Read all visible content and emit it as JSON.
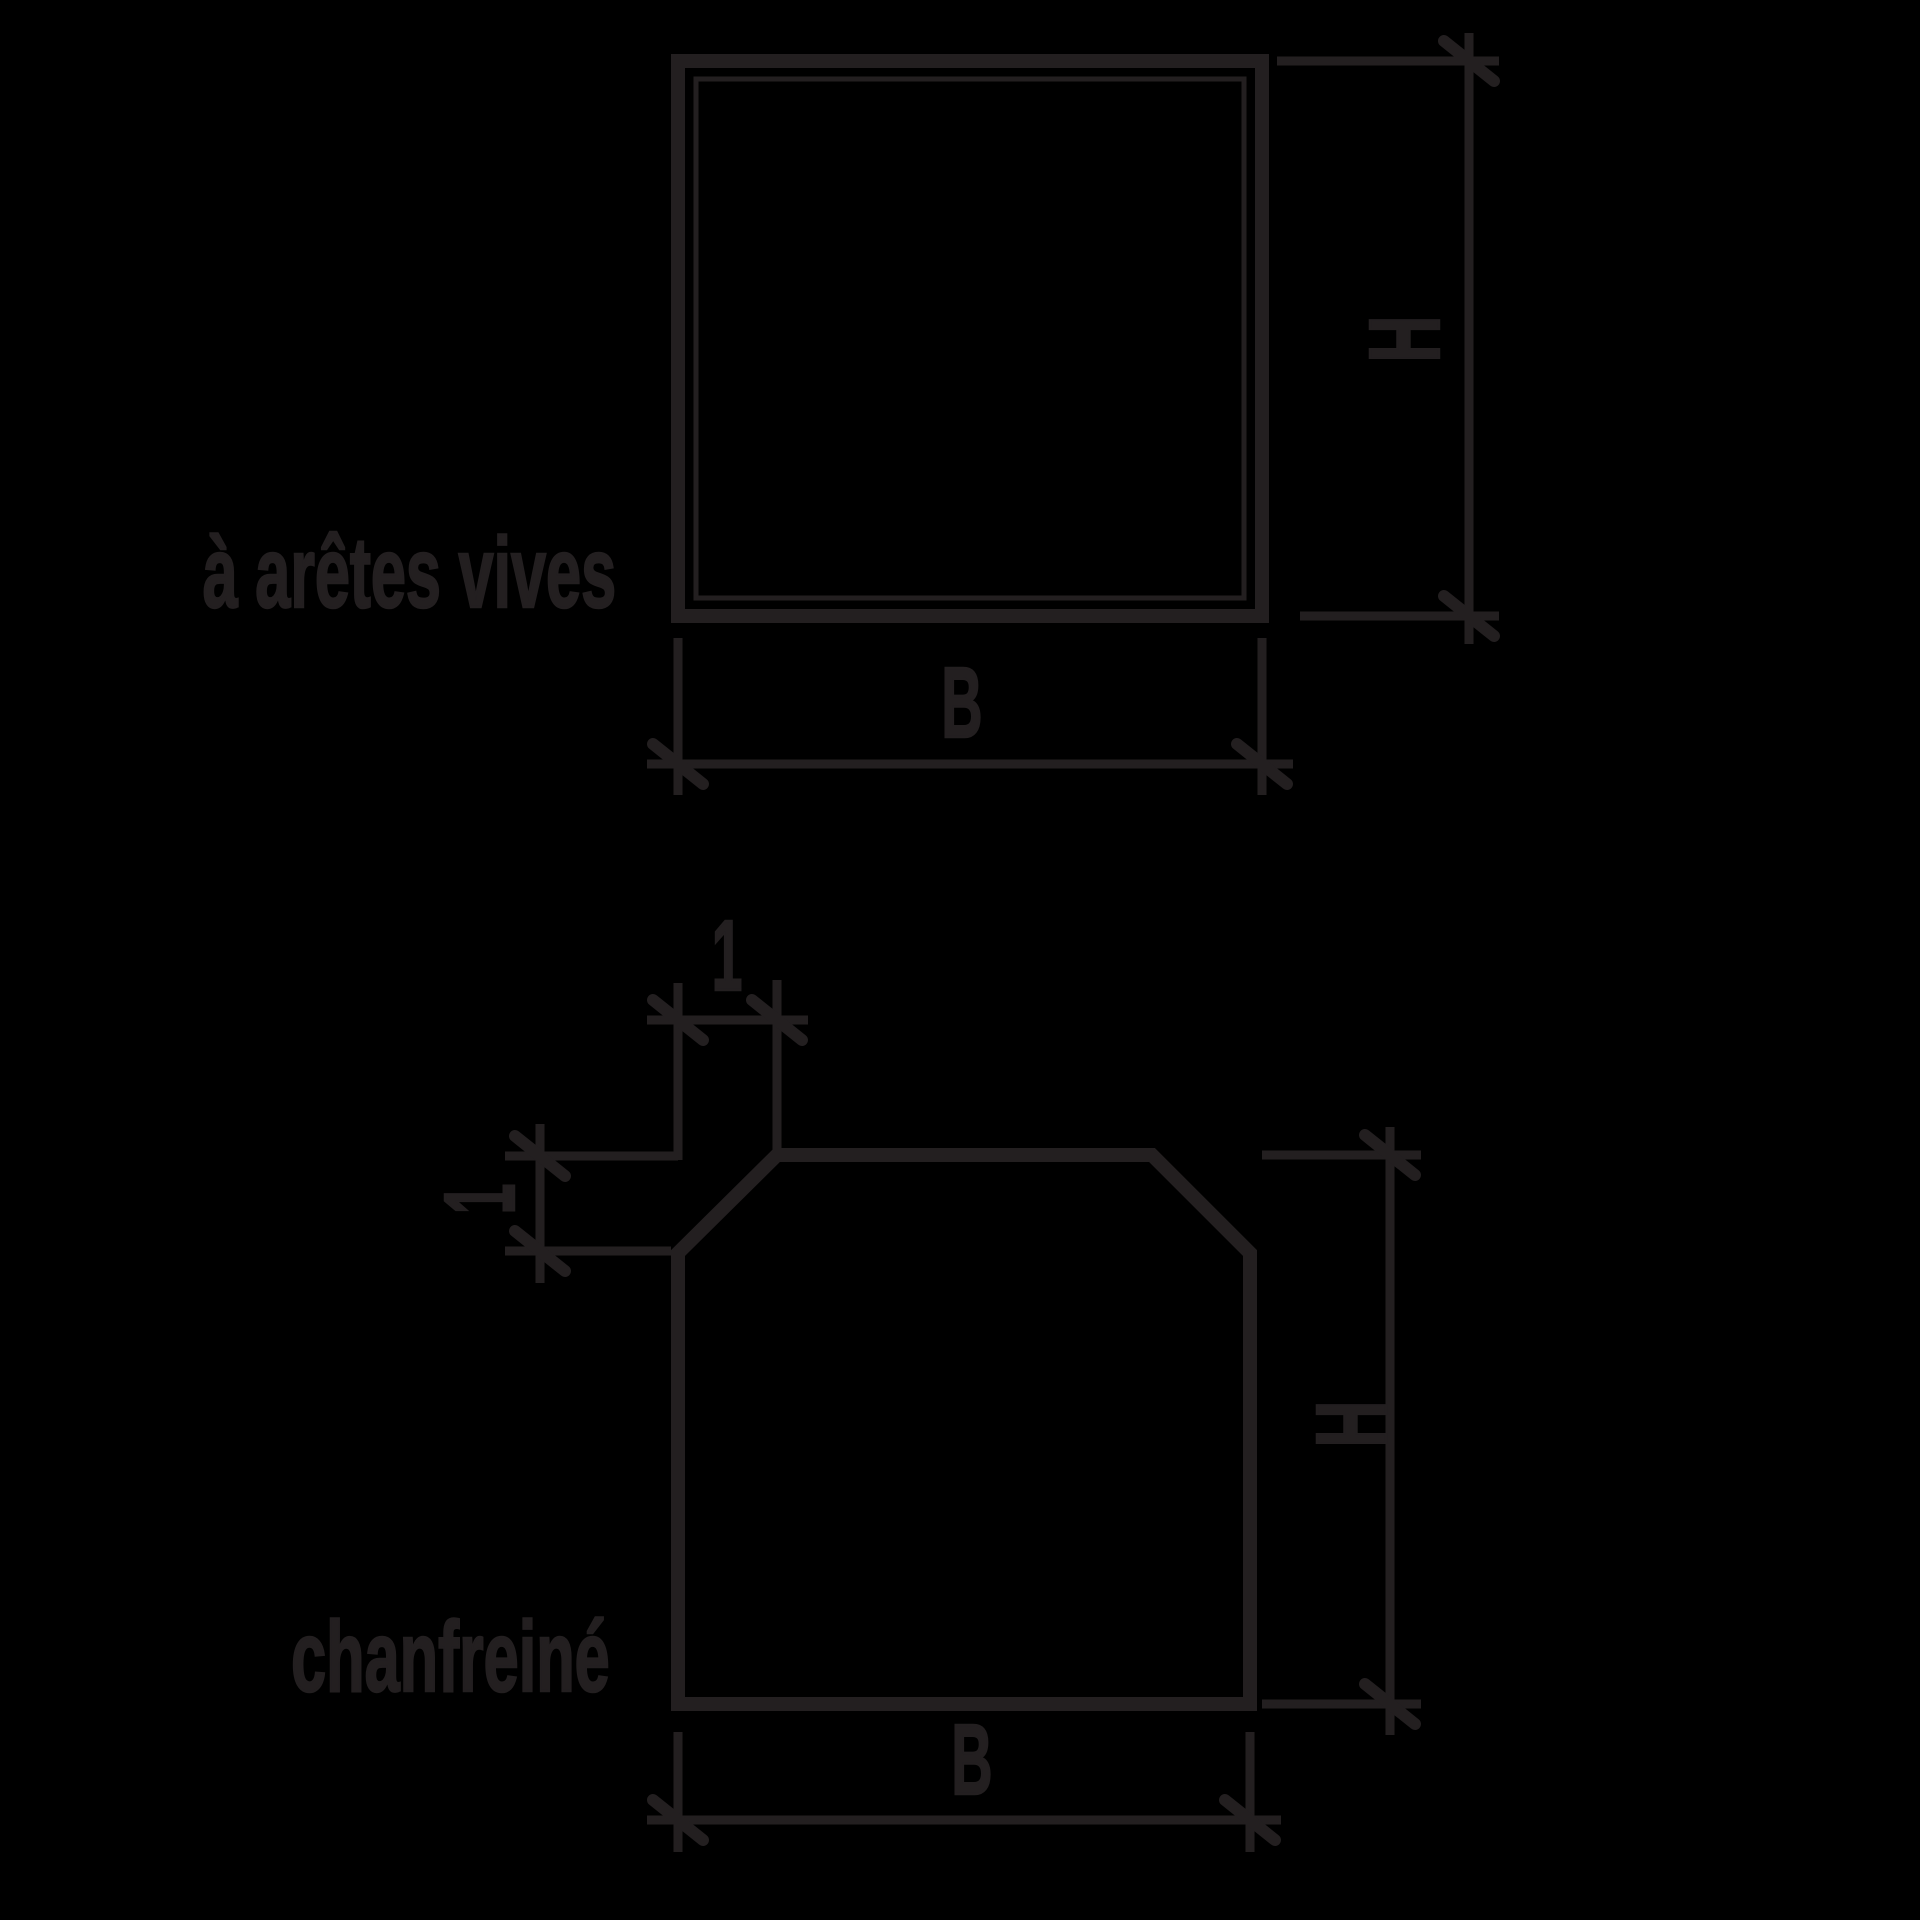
{
  "colors": {
    "ink": "#231f20",
    "background": "#000000"
  },
  "figures": [
    {
      "caption": "à arêtes vives",
      "height_label": "H",
      "width_label": "B"
    },
    {
      "caption": "chanfreiné",
      "height_label": "H",
      "width_label": "B",
      "chamfer_top_label": "1",
      "chamfer_side_label": "1"
    }
  ]
}
